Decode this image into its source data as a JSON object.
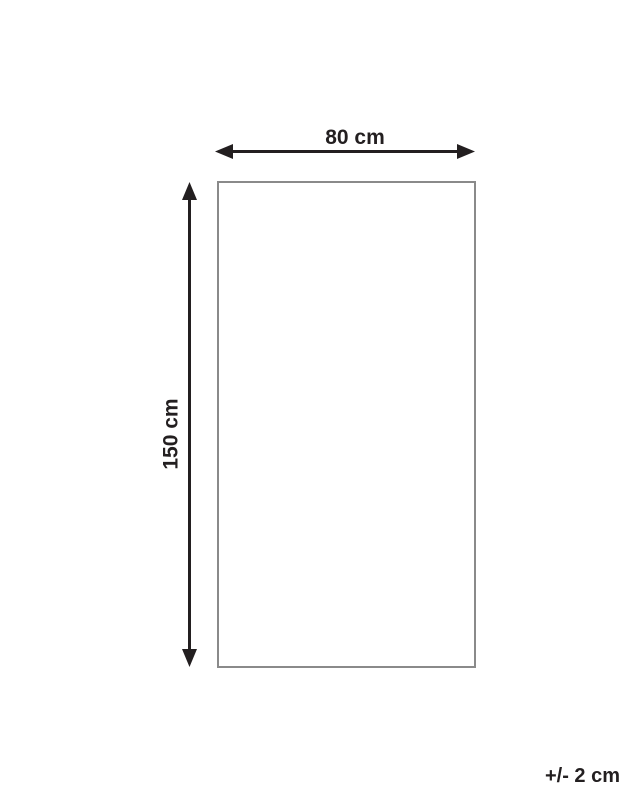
{
  "diagram": {
    "type": "product-dimension-diagram",
    "width_label": "80 cm",
    "height_label": "150 cm",
    "tolerance_label": "+/- 2 cm"
  },
  "colors": {
    "arrow": "#231f20",
    "outline": "#8a8a8a",
    "background": "#ffffff"
  }
}
